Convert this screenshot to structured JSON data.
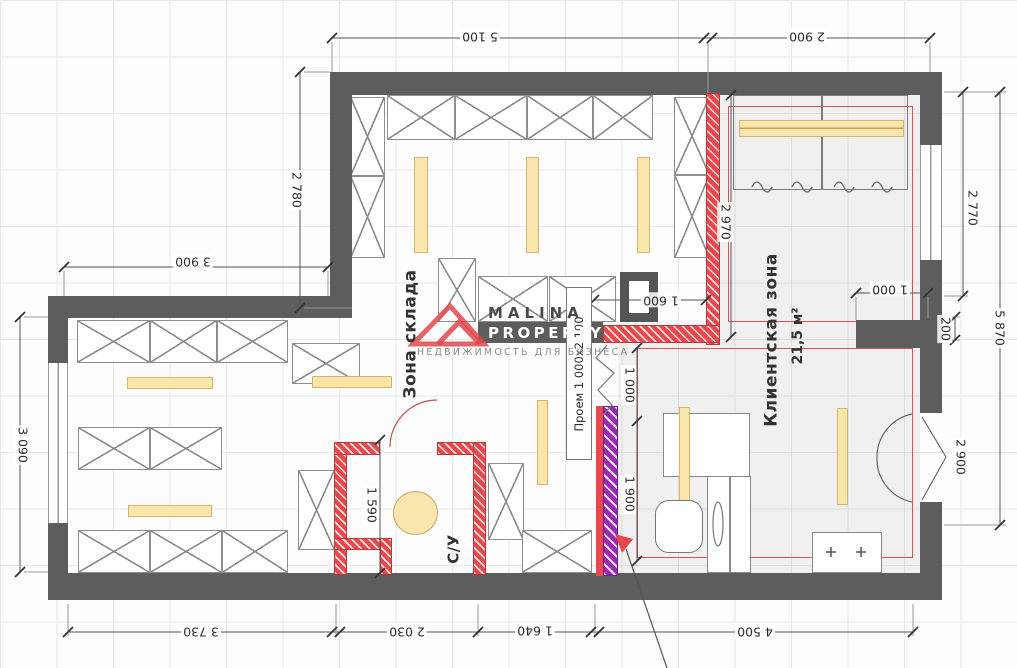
{
  "watermark": {
    "brand_top": "MALINA",
    "brand_bottom": "PROPERTY",
    "tagline": "НЕДВИЖИМОСТЬ ДЛЯ БИЗНЕСА"
  },
  "rooms": {
    "warehouse": "Зона склада",
    "client": "Клиентская зона",
    "client_area": "21,5 м²",
    "wc": "С/У"
  },
  "opening_label": "Проем 1 000х2 100",
  "dimensions": {
    "top_left": "5 100",
    "top_right": "2 900",
    "left_top": "2 780",
    "left_mid": "3 900",
    "left_bottom": "3 090",
    "right_upper": "2 770",
    "right_total": "5 870",
    "right_pilaster": "200",
    "right_door": "2 900",
    "bottom_1": "3 730",
    "bottom_2": "2 030",
    "bottom_3": "1 640",
    "bottom_4": "4 500",
    "inner_top": "1 600",
    "inner_pass": "1 000",
    "inner_pilaster": "1 000",
    "inner_showcase": "1 900",
    "inner_fitting": "2 970",
    "inner_wc": "1 590"
  },
  "colors": {
    "wall": "#5d5d5d",
    "new_wall": "#e8474b",
    "light": "#f9e6ac",
    "showcase": "#9c27b0",
    "outline": "#e05252"
  }
}
